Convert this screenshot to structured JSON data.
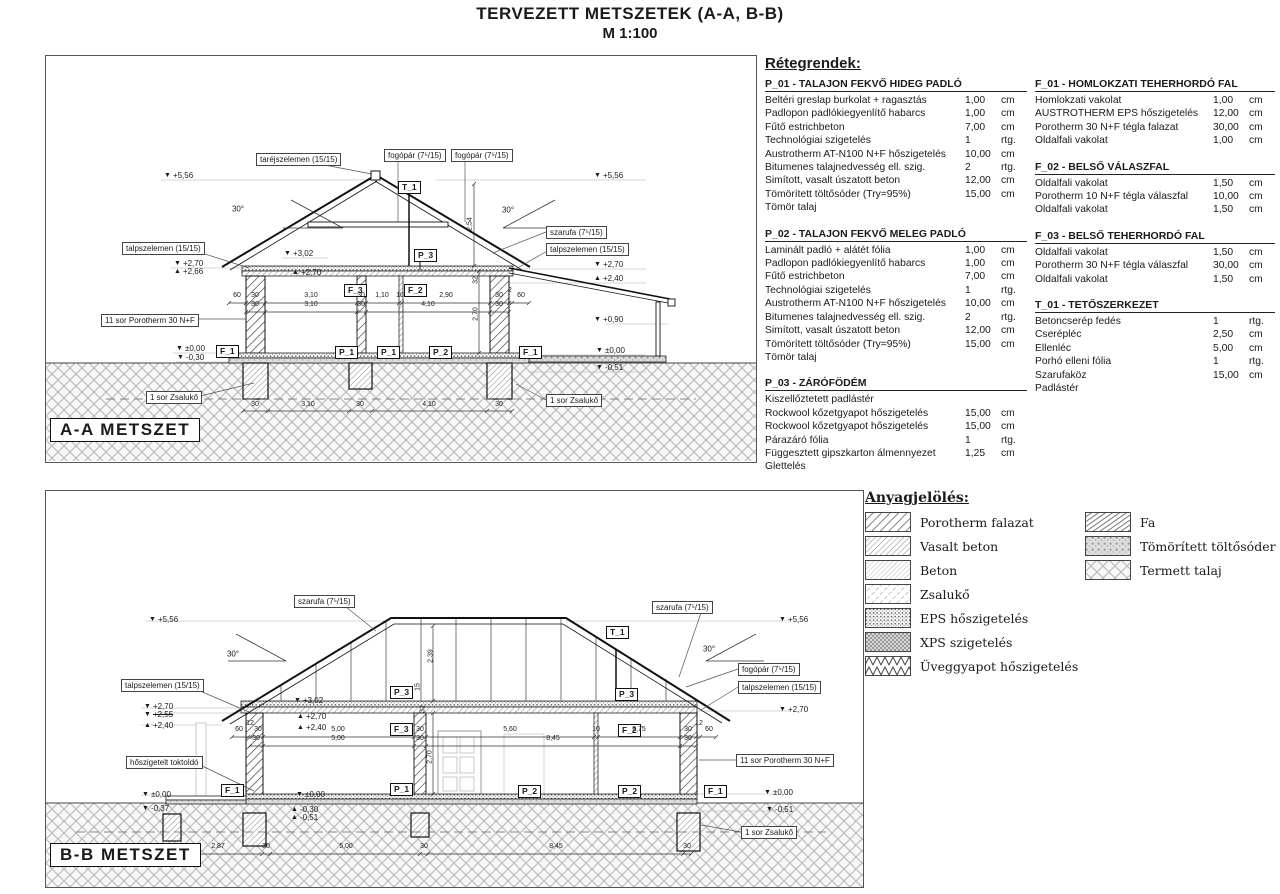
{
  "title": {
    "line1": "TERVEZETT METSZETEK (A-A, B-B)",
    "line2": "M  1:100"
  },
  "layers": {
    "heading": "Rétegrendek:",
    "col1": [
      {
        "title": "P_01 - TALAJON FEKVŐ HIDEG PADLÓ",
        "rows": [
          [
            "Beltéri greslap burkolat + ragasztás",
            "1,00",
            "cm"
          ],
          [
            "Padlopon padlókiegyenlítő habarcs",
            "1,00",
            "cm"
          ],
          [
            "Fűtő estrichbeton",
            "7,00",
            "cm"
          ],
          [
            "Technológiai szigetelés",
            "1",
            "rtg."
          ],
          [
            "Austrotherm AT-N100 N+F hőszigetelés",
            "10,00",
            "cm"
          ],
          [
            "Bitumenes talajnedvesség ell. szig.",
            "2",
            "rtg."
          ],
          [
            "Simított, vasalt úszatott beton",
            "12,00",
            "cm"
          ],
          [
            "Tömörített töltősóder (Try=95%)",
            "15,00",
            "cm"
          ],
          [
            "Tömör talaj",
            "",
            ""
          ]
        ]
      },
      {
        "title": "P_02 - TALAJON FEKVŐ MELEG PADLÓ",
        "rows": [
          [
            "Laminált padló + alátét fólia",
            "1,00",
            "cm"
          ],
          [
            "Padlopon padlókiegyenlítő habarcs",
            "1,00",
            "cm"
          ],
          [
            "Fűtő estrichbeton",
            "7,00",
            "cm"
          ],
          [
            "Technológiai szigetelés",
            "1",
            "rtg."
          ],
          [
            "Austrotherm AT-N100 N+F hőszigetelés",
            "10,00",
            "cm"
          ],
          [
            "Bitumenes talajnedvesség ell. szig.",
            "2",
            "rtg."
          ],
          [
            "Simított, vasalt úszatott beton",
            "12,00",
            "cm"
          ],
          [
            "Tömörített töltősóder (Try=95%)",
            "15,00",
            "cm"
          ],
          [
            "Tömör talaj",
            "",
            ""
          ]
        ]
      },
      {
        "title": "P_03 - ZÁRÓFÖDÉM",
        "rows": [
          [
            "Kiszellőztetett padlástér",
            "",
            ""
          ],
          [
            "Rockwool kőzetgyapot hőszigetelés",
            "15,00",
            "cm"
          ],
          [
            "Rockwool kőzetgyapot hőszigetelés",
            "15,00",
            "cm"
          ],
          [
            "Párazáró fólia",
            "1",
            "rtg."
          ],
          [
            "Függesztett gipszkarton álmennyezet",
            "1,25",
            "cm"
          ],
          [
            "Glettelés",
            "",
            ""
          ]
        ]
      }
    ],
    "col2": [
      {
        "title": "F_01 - HOMLOKZATI TEHERHORDÓ FAL",
        "rows": [
          [
            "Homlokzati vakolat",
            "1,00",
            "cm"
          ],
          [
            "AUSTROTHERM EPS hőszigetelés",
            "12,00",
            "cm"
          ],
          [
            "Porotherm 30 N+F tégla falazat",
            "30,00",
            "cm"
          ],
          [
            "Oldalfali vakolat",
            "1,00",
            "cm"
          ]
        ]
      },
      {
        "title": "F_02 - BELSŐ VÁLASZFAL",
        "rows": [
          [
            "Oldalfali vakolat",
            "1,50",
            "cm"
          ],
          [
            "Porotherm 10 N+F tégla válaszfal",
            "10,00",
            "cm"
          ],
          [
            "Oldalfali vakolat",
            "1,50",
            "cm"
          ]
        ]
      },
      {
        "title": "F_03 - BELSŐ TEHERHORDÓ FAL",
        "rows": [
          [
            "Oldalfali vakolat",
            "1,50",
            "cm"
          ],
          [
            "Porotherm 30 N+F tégla válaszfal",
            "30,00",
            "cm"
          ],
          [
            "Oldalfali vakolat",
            "1,50",
            "cm"
          ]
        ]
      },
      {
        "title": "T_01 - TETŐSZERKEZET",
        "rows": [
          [
            "Betoncserép fedés",
            "1",
            "rtg."
          ],
          [
            "Cserépléc",
            "2,50",
            "cm"
          ],
          [
            "Ellenléc",
            "5,00",
            "cm"
          ],
          [
            "Porhó elleni fólia",
            "1",
            "rtg."
          ],
          [
            "Szarufaköz",
            "15,00",
            "cm"
          ],
          [
            "Padlástér",
            "",
            ""
          ]
        ]
      }
    ]
  },
  "materials": {
    "heading": "Anyagjelölés:",
    "col1": [
      {
        "label": "Porotherm falazat",
        "pattern": "poro"
      },
      {
        "label": "Vasalt beton",
        "pattern": "vas"
      },
      {
        "label": "Beton",
        "pattern": "beton"
      },
      {
        "label": "Zsalukő",
        "pattern": "zsalu"
      },
      {
        "label": "EPS hőszigetelés",
        "pattern": "eps"
      },
      {
        "label": "XPS szigetelés",
        "pattern": "xps"
      },
      {
        "label": "Üveggyapot hőszigetelés",
        "pattern": "glass"
      }
    ],
    "col2": [
      {
        "label": "Fa",
        "pattern": "fa"
      },
      {
        "label": "Tömörített töltősóder",
        "pattern": "soder"
      },
      {
        "label": "Termett talaj",
        "pattern": "talaj"
      }
    ]
  },
  "section_a": {
    "annotations": [
      {
        "k": "box",
        "t": "taréjszelemen (15/15)",
        "x": 210,
        "y": 97
      },
      {
        "k": "box",
        "t": "fogópár (7⁵/15)",
        "x": 338,
        "y": 93
      },
      {
        "k": "box",
        "t": "fogópár (7⁵/15)",
        "x": 405,
        "y": 93
      },
      {
        "k": "box",
        "t": "szarufa (7⁵/15)",
        "x": 500,
        "y": 170
      },
      {
        "k": "box",
        "t": "talpszelemen (15/15)",
        "x": 76,
        "y": 186
      },
      {
        "k": "box",
        "t": "talpszelemen (15/15)",
        "x": 500,
        "y": 187
      },
      {
        "k": "box",
        "t": "11 sor Porotherm 30 N+F",
        "x": 55,
        "y": 258
      },
      {
        "k": "box",
        "t": "1 sor Zsalukő",
        "x": 100,
        "y": 335
      },
      {
        "k": "box",
        "t": "1 sor Zsalukő",
        "x": 500,
        "y": 338
      },
      {
        "k": "tag",
        "t": "T_1",
        "x": 352,
        "y": 125
      },
      {
        "k": "tag",
        "t": "P_3",
        "x": 368,
        "y": 193
      },
      {
        "k": "tag",
        "t": "F_3",
        "x": 298,
        "y": 228
      },
      {
        "k": "tag",
        "t": "F_2",
        "x": 358,
        "y": 228
      },
      {
        "k": "tag",
        "t": "F_1",
        "x": 170,
        "y": 289
      },
      {
        "k": "tag",
        "t": "P_1",
        "x": 289,
        "y": 290
      },
      {
        "k": "tag",
        "t": "P_1",
        "x": 331,
        "y": 290
      },
      {
        "k": "tag",
        "t": "P_2",
        "x": 383,
        "y": 290
      },
      {
        "k": "tag",
        "t": "F_1",
        "x": 473,
        "y": 290
      },
      {
        "k": "lvl",
        "t": "+5,56",
        "x": 118,
        "y": 115
      },
      {
        "k": "lvl",
        "t": "+5,56",
        "x": 548,
        "y": 115
      },
      {
        "k": "lvl",
        "t": "+2,70",
        "x": 128,
        "y": 203
      },
      {
        "k": "lvl",
        "t": "+2,66",
        "x": 128,
        "y": 211,
        "tri": "u"
      },
      {
        "k": "lvl",
        "t": "+3,02",
        "x": 238,
        "y": 193
      },
      {
        "k": "lvl",
        "t": "+2,70",
        "x": 246,
        "y": 212,
        "tri": "u"
      },
      {
        "k": "lvl",
        "t": "+2,70",
        "x": 548,
        "y": 204
      },
      {
        "k": "lvl",
        "t": "+2,40",
        "x": 548,
        "y": 218,
        "tri": "u"
      },
      {
        "k": "lvl",
        "t": "+0,90",
        "x": 548,
        "y": 259
      },
      {
        "k": "lvl",
        "t": "±0,00",
        "x": 130,
        "y": 288
      },
      {
        "k": "lvl",
        "t": "-0,30",
        "x": 131,
        "y": 297
      },
      {
        "k": "lvl",
        "t": "±0,00",
        "x": 550,
        "y": 290
      },
      {
        "k": "lvl",
        "t": "-0,51",
        "x": 550,
        "y": 307
      },
      {
        "k": "deg",
        "t": "30°",
        "x": 192,
        "y": 153
      },
      {
        "k": "deg",
        "t": "30°",
        "x": 462,
        "y": 154
      },
      {
        "k": "dim",
        "t": "60",
        "x": 191,
        "y": 243
      },
      {
        "k": "dim",
        "t": "30",
        "x": 209,
        "y": 243
      },
      {
        "k": "dim",
        "t": "3,10",
        "x": 265,
        "y": 243
      },
      {
        "k": "dim",
        "t": "30",
        "x": 315,
        "y": 243
      },
      {
        "k": "dim",
        "t": "1,10",
        "x": 336,
        "y": 243
      },
      {
        "k": "dim",
        "t": "10",
        "x": 354,
        "y": 243
      },
      {
        "k": "dim",
        "t": "2,90",
        "x": 400,
        "y": 243
      },
      {
        "k": "dim",
        "t": "30",
        "x": 453,
        "y": 243
      },
      {
        "k": "dim",
        "t": "2",
        "x": 464,
        "y": 238
      },
      {
        "k": "dim",
        "t": "60",
        "x": 475,
        "y": 243
      },
      {
        "k": "dim",
        "t": "30",
        "x": 209,
        "y": 252
      },
      {
        "k": "dim",
        "t": "3,10",
        "x": 265,
        "y": 252
      },
      {
        "k": "dim",
        "t": "30",
        "x": 315,
        "y": 252
      },
      {
        "k": "dim",
        "t": "4,10",
        "x": 382,
        "y": 252
      },
      {
        "k": "dim",
        "t": "30",
        "x": 453,
        "y": 252
      },
      {
        "k": "dim",
        "t": "30",
        "x": 209,
        "y": 352
      },
      {
        "k": "dim",
        "t": "3,10",
        "x": 262,
        "y": 352
      },
      {
        "k": "dim",
        "t": "30",
        "x": 314,
        "y": 352
      },
      {
        "k": "dim",
        "t": "4,10",
        "x": 383,
        "y": 352
      },
      {
        "k": "dim",
        "t": "30",
        "x": 453,
        "y": 352
      },
      {
        "k": "dim",
        "t": "2,54",
        "x": 424,
        "y": 168,
        "rot": 1
      },
      {
        "k": "dim",
        "t": "32",
        "x": 430,
        "y": 224,
        "rot": 1
      },
      {
        "k": "dim",
        "t": "2,70",
        "x": 430,
        "y": 258,
        "rot": 1
      },
      {
        "k": "stitle",
        "t": "A-A  METSZET",
        "x": 4,
        "y": 362
      }
    ]
  },
  "section_b": {
    "annotations": [
      {
        "k": "box",
        "t": "szarufa (7⁵/15)",
        "x": 248,
        "y": 104
      },
      {
        "k": "box",
        "t": "szarufa (7⁵/15)",
        "x": 606,
        "y": 110
      },
      {
        "k": "box",
        "t": "fogópár (7⁵/15)",
        "x": 692,
        "y": 172
      },
      {
        "k": "box",
        "t": "talpszelemen (15/15)",
        "x": 75,
        "y": 188
      },
      {
        "k": "box",
        "t": "talpszelemen (15/15)",
        "x": 692,
        "y": 190
      },
      {
        "k": "box",
        "t": "hőszigetelt toktoldó",
        "x": 80,
        "y": 265
      },
      {
        "k": "box",
        "t": "11 sor Porotherm 30 N+F",
        "x": 690,
        "y": 263
      },
      {
        "k": "box",
        "t": "1 sor Zsalukő",
        "x": 695,
        "y": 335
      },
      {
        "k": "tag",
        "t": "T_1",
        "x": 560,
        "y": 135
      },
      {
        "k": "tag",
        "t": "P_3",
        "x": 344,
        "y": 195
      },
      {
        "k": "tag",
        "t": "P_3",
        "x": 569,
        "y": 197
      },
      {
        "k": "tag",
        "t": "F_3",
        "x": 344,
        "y": 232
      },
      {
        "k": "tag",
        "t": "F_2",
        "x": 572,
        "y": 233
      },
      {
        "k": "tag",
        "t": "F_1",
        "x": 175,
        "y": 293
      },
      {
        "k": "tag",
        "t": "P_1",
        "x": 344,
        "y": 292
      },
      {
        "k": "tag",
        "t": "P_2",
        "x": 472,
        "y": 294
      },
      {
        "k": "tag",
        "t": "P_2",
        "x": 572,
        "y": 294
      },
      {
        "k": "tag",
        "t": "F_1",
        "x": 658,
        "y": 294
      },
      {
        "k": "lvl",
        "t": "+5,56",
        "x": 103,
        "y": 124
      },
      {
        "k": "lvl",
        "t": "+5,56",
        "x": 733,
        "y": 124
      },
      {
        "k": "lvl",
        "t": "+2,70",
        "x": 98,
        "y": 211
      },
      {
        "k": "lvl",
        "t": "+2,55",
        "x": 98,
        "y": 219,
        "s": 1
      },
      {
        "k": "lvl",
        "t": "+2,40",
        "x": 98,
        "y": 230,
        "tri": "u"
      },
      {
        "k": "lvl",
        "t": "+3,02",
        "x": 248,
        "y": 205
      },
      {
        "k": "lvl",
        "t": "+2,70",
        "x": 251,
        "y": 221,
        "tri": "u"
      },
      {
        "k": "lvl",
        "t": "+2,40",
        "x": 251,
        "y": 232,
        "tri": "u"
      },
      {
        "k": "lvl",
        "t": "+2,70",
        "x": 733,
        "y": 214
      },
      {
        "k": "lvl",
        "t": "±0,00",
        "x": 96,
        "y": 299
      },
      {
        "k": "lvl",
        "t": "-0,37",
        "x": 96,
        "y": 313
      },
      {
        "k": "lvl",
        "t": "±0,00",
        "x": 250,
        "y": 299
      },
      {
        "k": "lvl",
        "t": "-0,30",
        "x": 245,
        "y": 314,
        "tri": "u"
      },
      {
        "k": "lvl",
        "t": "-0,51",
        "x": 245,
        "y": 322,
        "tri": "u"
      },
      {
        "k": "lvl",
        "t": "±0,00",
        "x": 718,
        "y": 297
      },
      {
        "k": "lvl",
        "t": "-0,51",
        "x": 720,
        "y": 314
      },
      {
        "k": "deg",
        "t": "30°",
        "x": 187,
        "y": 163
      },
      {
        "k": "deg",
        "t": "30°",
        "x": 663,
        "y": 158
      },
      {
        "k": "dim",
        "t": "60",
        "x": 193,
        "y": 242
      },
      {
        "k": "dim",
        "t": "12",
        "x": 204,
        "y": 236
      },
      {
        "k": "dim",
        "t": "30",
        "x": 212,
        "y": 242
      },
      {
        "k": "dim",
        "t": "5,00",
        "x": 292,
        "y": 242
      },
      {
        "k": "dim",
        "t": "30",
        "x": 374,
        "y": 242
      },
      {
        "k": "dim",
        "t": "5,60",
        "x": 464,
        "y": 242
      },
      {
        "k": "dim",
        "t": "10",
        "x": 550,
        "y": 242
      },
      {
        "k": "dim",
        "t": "2,75",
        "x": 593,
        "y": 242
      },
      {
        "k": "dim",
        "t": "30",
        "x": 642,
        "y": 242
      },
      {
        "k": "dim",
        "t": "12",
        "x": 653,
        "y": 236
      },
      {
        "k": "dim",
        "t": "60",
        "x": 663,
        "y": 242
      },
      {
        "k": "dim",
        "t": "30",
        "x": 210,
        "y": 251
      },
      {
        "k": "dim",
        "t": "5,00",
        "x": 292,
        "y": 251
      },
      {
        "k": "dim",
        "t": "30",
        "x": 374,
        "y": 251
      },
      {
        "k": "dim",
        "t": "8,45",
        "x": 507,
        "y": 251
      },
      {
        "k": "dim",
        "t": "30",
        "x": 642,
        "y": 251
      },
      {
        "k": "dim",
        "t": "25",
        "x": 126,
        "y": 359
      },
      {
        "k": "dim",
        "t": "2,87",
        "x": 172,
        "y": 359
      },
      {
        "k": "dim",
        "t": "30",
        "x": 220,
        "y": 359
      },
      {
        "k": "dim",
        "t": "5,00",
        "x": 300,
        "y": 359
      },
      {
        "k": "dim",
        "t": "30",
        "x": 378,
        "y": 359
      },
      {
        "k": "dim",
        "t": "8,45",
        "x": 510,
        "y": 359
      },
      {
        "k": "dim",
        "t": "30",
        "x": 641,
        "y": 359
      },
      {
        "k": "dim",
        "t": "2,39",
        "x": 385,
        "y": 165,
        "rot": 1
      },
      {
        "k": "dim",
        "t": "15",
        "x": 372,
        "y": 196,
        "rot": 1
      },
      {
        "k": "dim",
        "t": "32",
        "x": 377,
        "y": 218,
        "rot": 1
      },
      {
        "k": "dim",
        "t": "2,70",
        "x": 384,
        "y": 266,
        "rot": 1
      },
      {
        "k": "stitle",
        "t": "B-B  METSZET",
        "x": 4,
        "y": 352
      }
    ]
  }
}
